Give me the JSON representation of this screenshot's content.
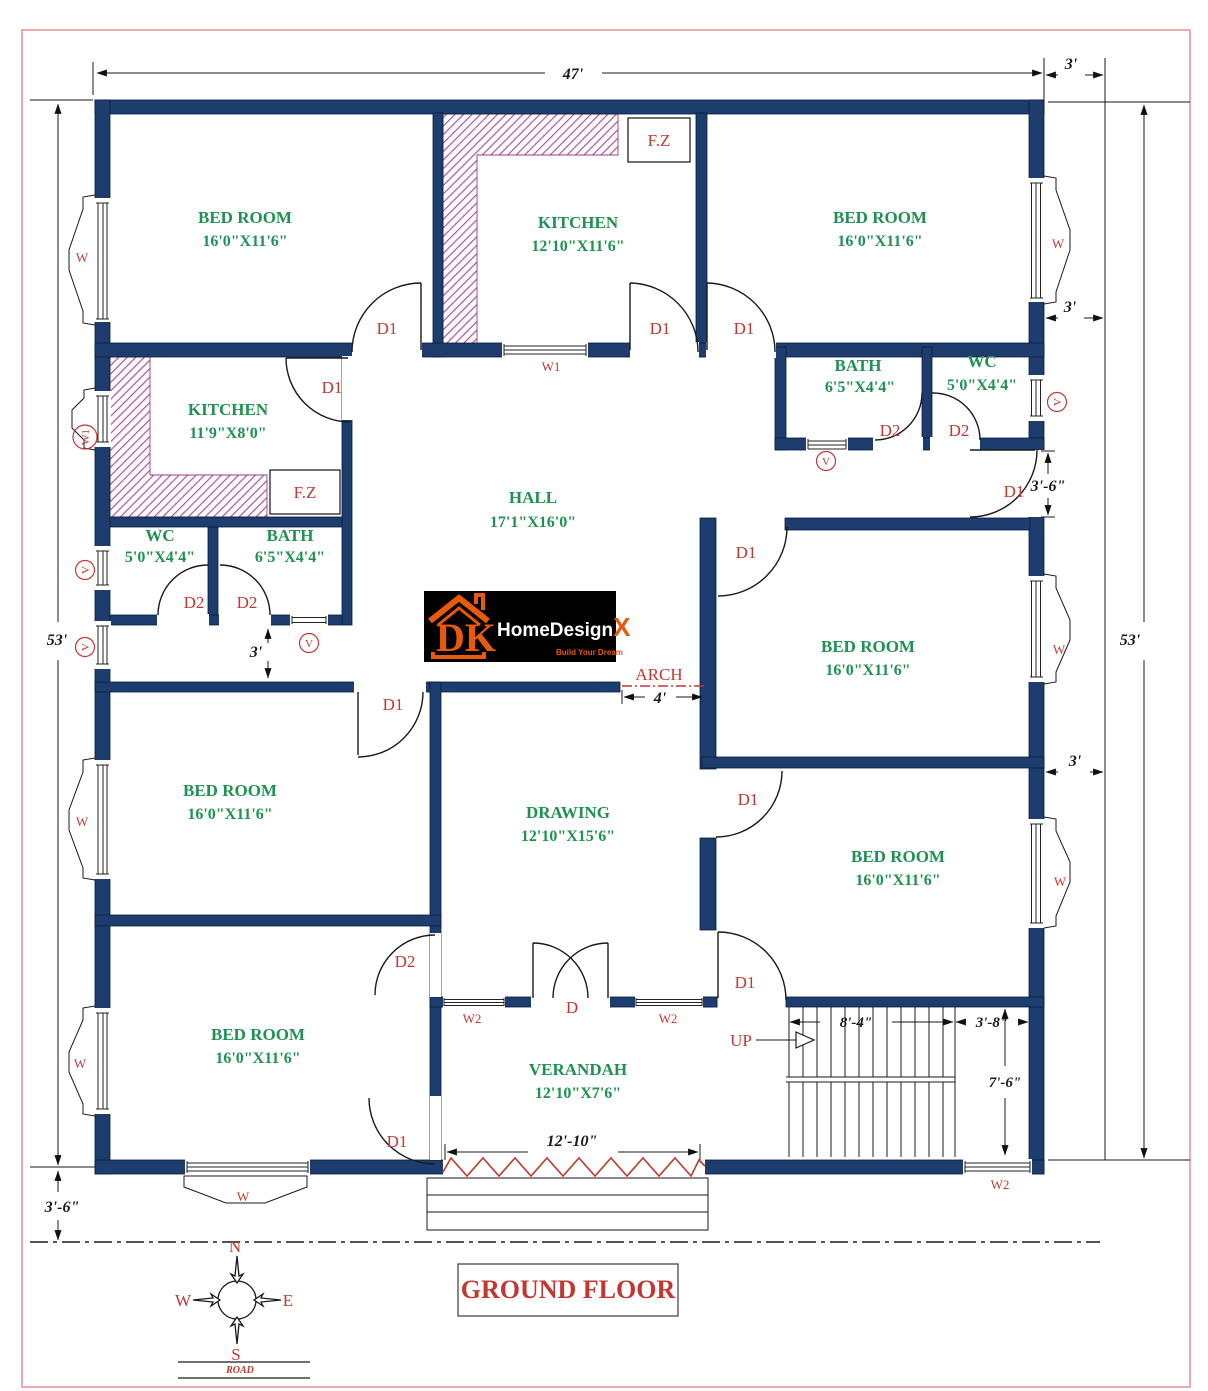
{
  "plan_title": "GROUND FLOOR",
  "road_label": "ROAD",
  "compass": {
    "n": "N",
    "e": "E",
    "s": "S",
    "w": "W"
  },
  "logo": {
    "dk": "DK",
    "name_1": "HomeDesign",
    "name_x": "X",
    "name_2": ".com",
    "tagline": "Build Your Dream",
    "bg_color": "#000000",
    "accent_color": "#e8590c"
  },
  "colors": {
    "wall": "#1c3d6e",
    "room_label": "#1f9150",
    "annotation": "#c13832",
    "counter_hatch": "#b1519f",
    "page_border": "#e59090"
  },
  "rooms": [
    {
      "name": "BED ROOM",
      "size": "16'0\"X11'6\""
    },
    {
      "name": "KITCHEN",
      "size": "12'10\"X11'6\""
    },
    {
      "name": "BED ROOM",
      "size": "16'0\"X11'6\""
    },
    {
      "name": "KITCHEN",
      "size": "11'9\"X8'0\""
    },
    {
      "name": "HALL",
      "size": "17'1\"X16'0\""
    },
    {
      "name": "WC",
      "size": "5'0\"X4'4\""
    },
    {
      "name": "BATH",
      "size": "6'5\"X4'4\""
    },
    {
      "name": "BATH",
      "size": "6'5\"X4'4\""
    },
    {
      "name": "WC",
      "size": "5'0\"X4'4\""
    },
    {
      "name": "BED ROOM",
      "size": "16'0\"X11'6\""
    },
    {
      "name": "BED ROOM",
      "size": "16'0\"X11'6\""
    },
    {
      "name": "DRAWING",
      "size": "12'10\"X15'6\""
    },
    {
      "name": "BED ROOM",
      "size": "16'0\"X11'6\""
    },
    {
      "name": "BED ROOM",
      "size": "16'0\"X11'6\""
    },
    {
      "name": "VERANDAH",
      "size": "12'10\"X7'6\""
    }
  ],
  "doors": {
    "d1": "D1",
    "d2": "D2",
    "double": "D",
    "up": "UP",
    "arch": "ARCH"
  },
  "windows": {
    "w": "W",
    "w1": "W1",
    "w2": "W2",
    "vent": "V"
  },
  "fz": "F.Z",
  "dimensions": {
    "width_main": "47'",
    "offset_right_top": "3'",
    "height_left": "53'",
    "height_right": "53'",
    "right_gap_1": "3'",
    "side_door_gap": "3'-6\"",
    "right_gap_2": "3'",
    "corridor": "3'",
    "arch_width": "4'",
    "verandah_front": "12'-10\"",
    "stair_flight": "8'-4\"",
    "stair_landing": "3'-8\"",
    "stair_well": "7'-6\"",
    "setback_bottom": "3'-6\""
  }
}
